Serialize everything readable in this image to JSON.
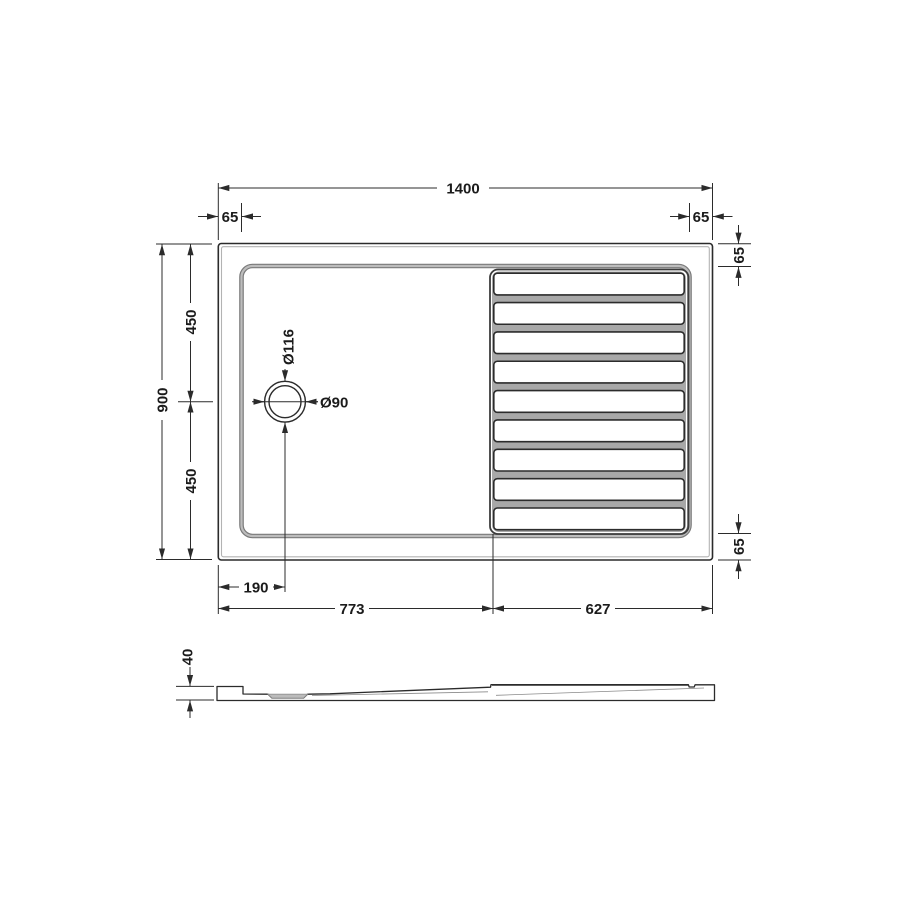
{
  "document": {
    "kind": "technical-drawing",
    "subject": "Rectangular walk-in shower tray - plan view and side elevation"
  },
  "colors": {
    "line": "#2b2b2b",
    "text": "#1b1b1b",
    "floor_gray": "#9b9b9b",
    "groove_gray": "#a8a8a8",
    "bump_gray": "#bcbcbc",
    "background": "#ffffff"
  },
  "plan_view": {
    "dimensions": {
      "overall_width": "1400",
      "overall_depth": "900",
      "top_left_edge": "65",
      "top_right_edge": "65",
      "right_upper_edge": "65",
      "right_lower_edge": "65",
      "upper_half_depth": "450",
      "lower_half_depth": "450",
      "drain_offset_from_left": "190",
      "smooth_zone_width": "773",
      "ribbed_zone_width": "627"
    },
    "drain": {
      "outer_diameter": "Ø116",
      "inner_diameter": "Ø90"
    },
    "ribs": {
      "count": 9
    }
  },
  "side_view": {
    "dimensions": {
      "tray_height": "40"
    }
  }
}
